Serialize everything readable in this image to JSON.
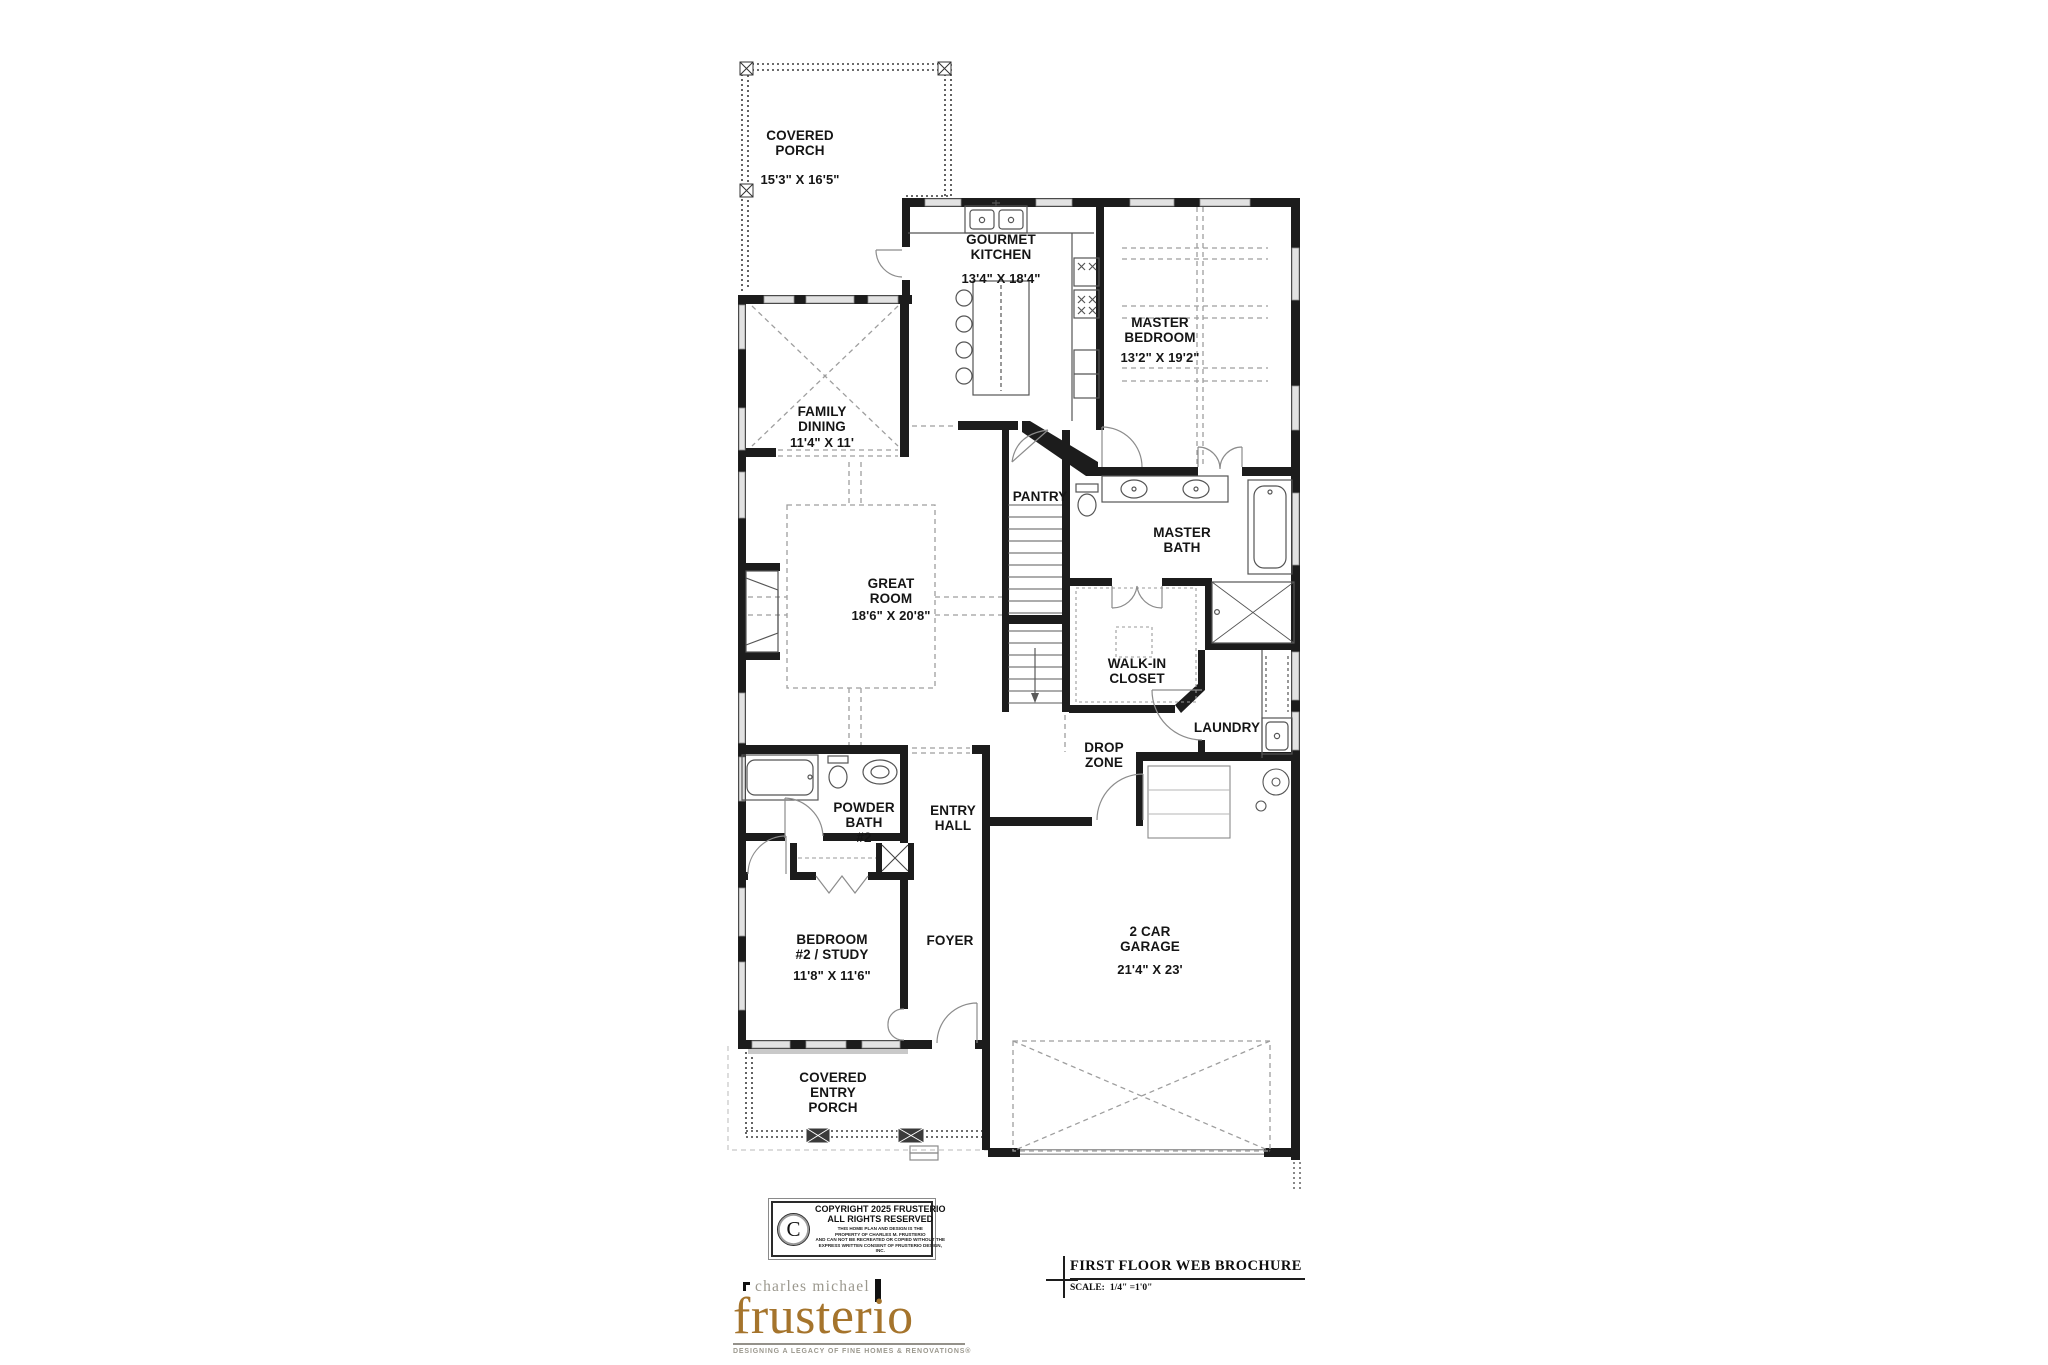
{
  "plan": {
    "rooms": [
      {
        "id": "covered-porch",
        "name": "COVERED\nPORCH",
        "dims": "15'3\" X 16'5\""
      },
      {
        "id": "gourmet-kitchen",
        "name": "GOURMET\nKITCHEN",
        "dims": "13'4\" X 18'4\""
      },
      {
        "id": "master-bedroom",
        "name": "MASTER\nBEDROOM",
        "dims": "13'2\" X 19'2\""
      },
      {
        "id": "family-dining",
        "name": "FAMILY\nDINING",
        "dims": "11'4\" X 11'"
      },
      {
        "id": "great-room",
        "name": "GREAT\nROOM",
        "dims": "18'6\" X 20'8\""
      },
      {
        "id": "pantry",
        "name": "PANTRY",
        "dims": ""
      },
      {
        "id": "master-bath",
        "name": "MASTER\nBATH",
        "dims": ""
      },
      {
        "id": "walk-in-closet",
        "name": "WALK-IN\nCLOSET",
        "dims": ""
      },
      {
        "id": "laundry",
        "name": "LAUNDRY",
        "dims": ""
      },
      {
        "id": "drop-zone",
        "name": "DROP\nZONE",
        "dims": ""
      },
      {
        "id": "powder-bath-2",
        "name": "POWDER\nBATH\n#2",
        "dims": ""
      },
      {
        "id": "entry-hall",
        "name": "ENTRY\nHALL",
        "dims": ""
      },
      {
        "id": "bedroom-2-study",
        "name": "BEDROOM\n#2 / STUDY",
        "dims": "11'8\" X 11'6\""
      },
      {
        "id": "foyer",
        "name": "FOYER",
        "dims": ""
      },
      {
        "id": "garage",
        "name": "2 CAR\nGARAGE",
        "dims": "21'4\" X 23'"
      },
      {
        "id": "covered-entry-porch",
        "name": "COVERED\nENTRY\nPORCH",
        "dims": ""
      }
    ],
    "colors": {
      "wall": "#1c1c1c",
      "window": "#e2e2e2",
      "dash": "#9e9e9e"
    }
  },
  "copyright": {
    "symbol": "C",
    "line1": "COPYRIGHT 2025 FRUSTERIO",
    "line2": "ALL RIGHTS RESERVED",
    "fine_print": "THIS HOME PLAN AND DESIGN IS THE\nPROPERTY OF CHARLES M. FRUSTERIO\nAND CAN NOT BE RECREATED OR COPIED WITHOUT THE\nEXPRESS WRITTEN CONSENT OF FRUSTERIO DESIGN, INC."
  },
  "title_block": {
    "title": "FIRST FLOOR WEB BROCHURE",
    "scale_label": "SCALE:",
    "scale_value": "1/4\" =1'0\""
  },
  "logo": {
    "top": "charles michael",
    "name": "frusterio",
    "tagline": "DESIGNING A LEGACY OF FINE HOMES & RENOVATIONS®",
    "brand_color": "#a5742c"
  }
}
